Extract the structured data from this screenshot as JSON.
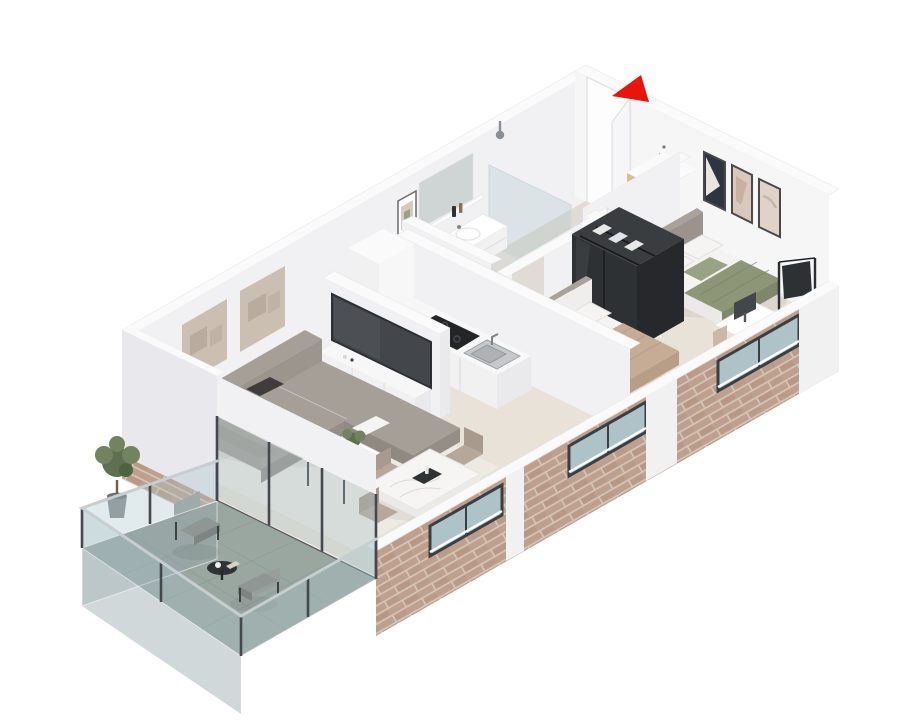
{
  "meta": {
    "type": "isometric-floor-plan-render",
    "description": "3D isometric cutaway floor plan of a two-bedroom apartment with balcony",
    "entrance_marker": "red-arrow"
  },
  "palette": {
    "bg": "#ffffff",
    "arrow_red": "#e8150d",
    "wall_cap": "#fafafa",
    "wall_face": "#f1f1f3",
    "wall_face_bright": "#f6f6f7",
    "wall_face_shade": "#e9e9ed",
    "wall_end": "#eaeaed",
    "floor_main": "#e8e2d8",
    "floor_bath": "#dbdad7",
    "floor_entry": "#e0dcd5",
    "rug": "#edeae3",
    "brick_base": "#bfa08f",
    "brick_accent": "#b2917e",
    "brick_mortar": "#d5c6b8",
    "balcony_floor": "#9aa7a1",
    "balcony_glass": "#aac4c9",
    "fascia_glass": "#96a9ab",
    "frame_dark": "#45494d",
    "metal_rail": "#c8cdcf",
    "sofa": "#a29c95",
    "sofa_shade": "#948e87",
    "sofa_dark": "#8f8982",
    "sofa_top": "#a59f98",
    "sofa_back": "#9b958e",
    "pillow_white": "#f5f4f2",
    "pillow_dark": "#3e3d3b",
    "tv_screen": "#43474b",
    "wood_shelf": "#d8bd95",
    "wood_line": "#bb9c72",
    "wood_stand": "#c9ae8e",
    "wood_stand_dark": "#b79b7c",
    "marble": "#f6f5f3",
    "marble_edge": "#eceae7",
    "chair_taupe": "#b5a89a",
    "chair_taupe_dark": "#a89a8c",
    "sage": "#8e9678",
    "sage_dark": "#7f8769",
    "sage_pillow": "#9aa284",
    "tan_blanket": "#c6ac94",
    "tan_dark": "#b89e86",
    "mattress": "#f4f3f1",
    "mattress_shade": "#e9e8e6",
    "mattress_side": "#eceae8",
    "headboard": "#9a948d",
    "headboard_top": "#a8a29b",
    "headboard2": "#efeeec",
    "mint": "#bcd8c8",
    "plant_green": "#5e7050",
    "plant_light": "#72835f",
    "steel": "#c6c9cb",
    "appliance": "#2e3033",
    "cooktop": "#232527",
    "window_glass": "#aec3c8",
    "jacket_blue": "#7f9dc2",
    "jacket_gray": "#8d949d",
    "art_navy": "#2f3540",
    "art_blush": "#d9c8bc",
    "art_blush2": "#e0d2c6",
    "art_stone": "#cbbfb2",
    "art_stone_dark": "#b9ac9e",
    "chair_beige": "#c8b8a4",
    "ward_front": "#2e3134",
    "ward_top": "#3a3d40",
    "ward_side": "#26282b",
    "white_box": "#f7f7f8",
    "white_face": "#f1f1f2",
    "cushion_gray": "#b8b4ad",
    "balcony_chair": "#8f9794",
    "balcony_chair_back": "#979e9b",
    "balcony_chair_face": "#7d8582",
    "table_dark": "#2f3335",
    "mirror": "#cfd4d4",
    "door_open_light": "#fdfdfd",
    "door_leaf": "#f6f6f8"
  },
  "rooms": [
    {
      "name": "living-room",
      "items": [
        "l-shaped-sofa",
        "coffee-table",
        "potted-plant",
        "area-rug",
        "tv",
        "media-unit",
        "wall-art-panels"
      ]
    },
    {
      "name": "dining-area",
      "items": [
        "marble-dining-table",
        "dining-chairs-x4",
        "decor-tray"
      ]
    },
    {
      "name": "kitchen",
      "items": [
        "counter",
        "induction-cooktop",
        "built-in-oven",
        "sink",
        "tall-cabinet"
      ]
    },
    {
      "name": "bathroom",
      "items": [
        "floating-vanity",
        "basin",
        "mirror",
        "wall-shelf",
        "walk-in-shower",
        "toilet",
        "framed-art"
      ]
    },
    {
      "name": "entry-hall",
      "items": [
        "entry-door",
        "coat-hooks",
        "jackets",
        "storage-bench",
        "open-shelf-unit"
      ]
    },
    {
      "name": "bedroom-main",
      "items": [
        "double-bed",
        "sage-throw",
        "nightstand",
        "lamp",
        "picture-frames-x3",
        "desk",
        "monitor",
        "desk-chair",
        "clothes-rack"
      ]
    },
    {
      "name": "bedroom-second",
      "items": [
        "double-bed",
        "tan-throw",
        "dark-wardrobe"
      ]
    },
    {
      "name": "balcony",
      "items": [
        "glass-railing",
        "tile-floor",
        "olive-plant",
        "lounge-chairs-x2",
        "side-table"
      ]
    }
  ]
}
